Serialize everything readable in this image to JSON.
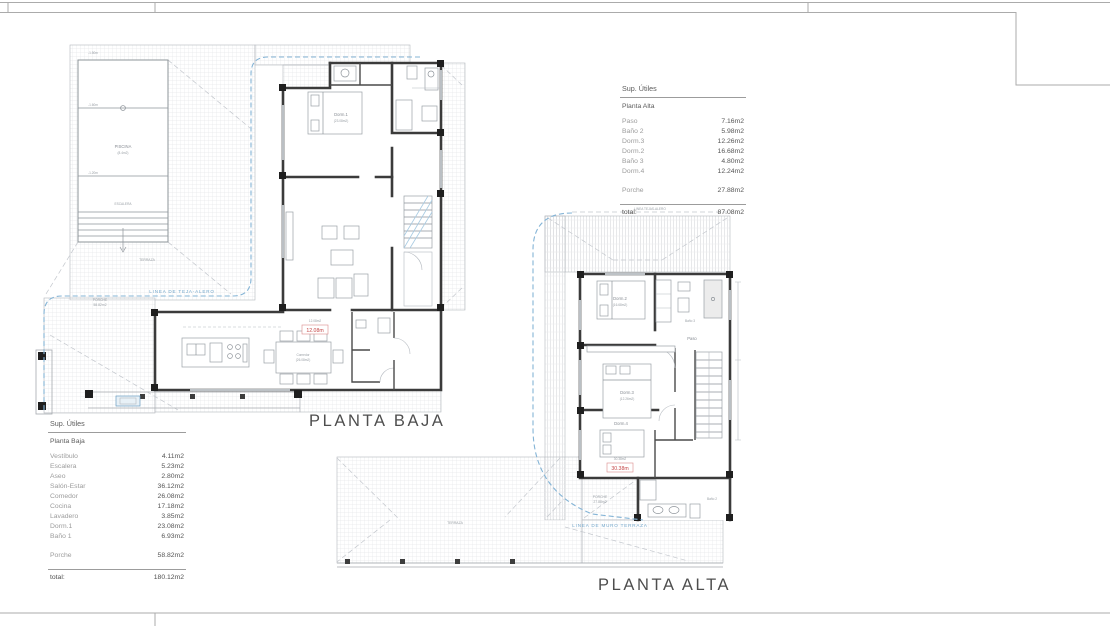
{
  "plans": {
    "baja": {
      "title": "PLANTA BAJA",
      "annotations": {
        "roof_line": "LINEA DE TEJA-ALERO",
        "red_value": "12.08m",
        "red_note": "12.08m2",
        "pool_name": "PISCINA",
        "pool_area": "(8.4m2)",
        "pool_depth_top": "-1.50m",
        "pool_depth_mid": "-1.60m",
        "pool_depth_low": "-1.20m",
        "pool_steps": "ESCALERA",
        "terraza": "TERRAZA",
        "porche_l1": "PORCHE",
        "porche_l2": "58.82m2",
        "dorm1": "Dorm.1",
        "dorm1_area": "(23.08m2)",
        "comedor": "Comedor",
        "comedor_area": "(26.08m2)"
      }
    },
    "alta": {
      "title": "PLANTA ALTA",
      "annotations": {
        "roof_top": "LINEA TEJAS-ALERO",
        "roof_line": "LINEA DE MURO TERRAZA",
        "red_value": "30.38m",
        "red_note": "30.38m2",
        "dorm2": "Dorm.2",
        "dorm2_area": "(16.68m2)",
        "dorm3": "Dorm.3",
        "dorm3_area": "(12.26m2)",
        "dorm4": "Dorm.4",
        "dorm4_area": "(12.24m2)",
        "paso": "Paso",
        "bano2": "Baño 2",
        "bano3": "Baño 3",
        "porche_l1": "PORCHE",
        "porche_l2": "27.88m2",
        "terraza": "TERRAZA"
      }
    }
  },
  "tables": {
    "baja": {
      "header": "Sup. Útiles",
      "subheader": "Planta Baja",
      "rows": [
        {
          "label": "Vestíbulo",
          "value": "4.11m2"
        },
        {
          "label": "Escalera",
          "value": "5.23m2"
        },
        {
          "label": "Aseo",
          "value": "2.80m2"
        },
        {
          "label": "Salón-Estar",
          "value": "36.12m2"
        },
        {
          "label": "Comedor",
          "value": "26.08m2"
        },
        {
          "label": "Cocina",
          "value": "17.18m2"
        },
        {
          "label": "Lavadero",
          "value": "3.85m2"
        },
        {
          "label": "Dorm.1",
          "value": "23.08m2"
        },
        {
          "label": "Baño 1",
          "value": "6.93m2"
        },
        {
          "label": "Porche",
          "value": "58.82m2",
          "gap": true
        }
      ],
      "total_label": "total:",
      "total_value": "180.12m2"
    },
    "alta": {
      "header": "Sup. Útiles",
      "subheader": "Planta Alta",
      "rows": [
        {
          "label": "Paso",
          "value": "7.16m2"
        },
        {
          "label": "Baño 2",
          "value": "5.98m2"
        },
        {
          "label": "Dorm.3",
          "value": "12.26m2"
        },
        {
          "label": "Dorm.2",
          "value": "16.68m2"
        },
        {
          "label": "Baño 3",
          "value": "4.80m2"
        },
        {
          "label": "Dorm.4",
          "value": "12.24m2"
        },
        {
          "label": "Porche",
          "value": "27.88m2",
          "gap": true
        }
      ],
      "total_label": "total:",
      "total_value": "87.08m2"
    }
  },
  "colors": {
    "wall": "#3b3b3b",
    "roofline_blue": "#84b4d6",
    "red_label": "#c44545",
    "hatch": "#e7e8ea",
    "frame": "#ababab"
  }
}
